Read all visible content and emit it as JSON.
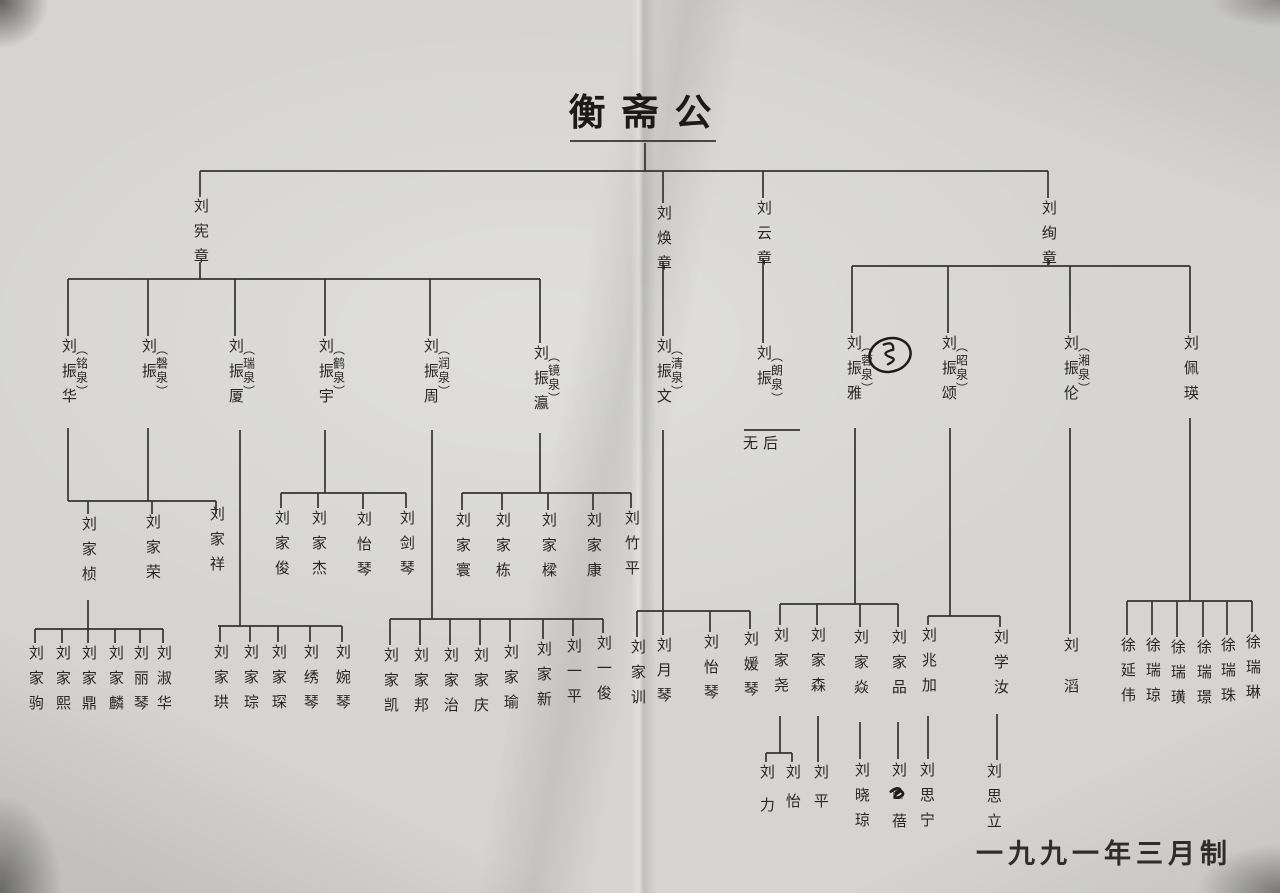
{
  "page": {
    "title": "衡斋公",
    "footer_date": "一九九一年三月制"
  },
  "colors": {
    "paper": "#d5d4d0",
    "ink": "#272624",
    "line": "#34332f"
  },
  "tree": {
    "root": "衡斋公",
    "no_descendants_note": "无后",
    "nodes": [
      {
        "id": "xianzhang",
        "name": "刘宪章",
        "x": 200,
        "y": 198
      },
      {
        "id": "huanzhang",
        "name": "刘焕章",
        "x": 663,
        "y": 205
      },
      {
        "id": "yunzhang",
        "name": "刘云章",
        "x": 763,
        "y": 200
      },
      {
        "id": "xuanzhang",
        "name": "刘绚章",
        "x": 1048,
        "y": 200
      },
      {
        "id": "zhenhua",
        "name": "刘振华",
        "paren": "铭泉",
        "x": 68,
        "y": 338
      },
      {
        "id": "zhen-qingquan",
        "name": "刘振",
        "paren": "磬泉",
        "x": 148,
        "y": 338
      },
      {
        "id": "zhensha",
        "name": "刘振厦",
        "paren": "瑞泉",
        "x": 235,
        "y": 338
      },
      {
        "id": "zhenyu",
        "name": "刘振宇",
        "paren": "鹤泉",
        "x": 325,
        "y": 338
      },
      {
        "id": "zhenzhou",
        "name": "刘振周",
        "paren": "润泉",
        "x": 430,
        "y": 338
      },
      {
        "id": "zhenying",
        "name": "刘振瀛",
        "paren": "镜泉",
        "x": 540,
        "y": 345
      },
      {
        "id": "zhenwen",
        "name": "刘振文",
        "paren": "清泉",
        "x": 663,
        "y": 338
      },
      {
        "id": "zhen-langquan",
        "name": "刘振",
        "paren": "朗泉",
        "x": 763,
        "y": 345
      },
      {
        "id": "wuhou",
        "name": "无后",
        "x": 763,
        "y": 437,
        "horizontal": true
      },
      {
        "id": "zhenya",
        "name": "刘振雅",
        "paren": "蓉泉",
        "x": 853,
        "y": 335
      },
      {
        "id": "zhensong",
        "name": "刘振颂",
        "paren": "昭泉",
        "x": 948,
        "y": 335
      },
      {
        "id": "zhenlun",
        "name": "刘振伦",
        "paren": "湘泉",
        "x": 1070,
        "y": 335
      },
      {
        "id": "peiying",
        "name": "刘佩瑛",
        "x": 1190,
        "y": 335
      },
      {
        "id": "jiazhen",
        "name": "刘家桢",
        "x": 88,
        "y": 516
      },
      {
        "id": "jiarong",
        "name": "刘家荣",
        "x": 152,
        "y": 514
      },
      {
        "id": "jiaxiang",
        "name": "刘家祥",
        "x": 216,
        "y": 506
      },
      {
        "id": "jiajun",
        "name": "刘家俊",
        "x": 281,
        "y": 510
      },
      {
        "id": "jiajie",
        "name": "刘家杰",
        "x": 318,
        "y": 510
      },
      {
        "id": "yiqin-a",
        "name": "刘怡琴",
        "x": 363,
        "y": 511
      },
      {
        "id": "jianqin",
        "name": "刘剑琴",
        "x": 406,
        "y": 510
      },
      {
        "id": "jiahuan",
        "name": "刘家寰",
        "x": 462,
        "y": 512
      },
      {
        "id": "jiadong",
        "name": "刘家栋",
        "x": 502,
        "y": 512
      },
      {
        "id": "jialiang",
        "name": "刘家樑",
        "x": 548,
        "y": 512
      },
      {
        "id": "jiakang",
        "name": "刘家康",
        "x": 593,
        "y": 512
      },
      {
        "id": "zhuping",
        "name": "刘竹平",
        "x": 631,
        "y": 510
      },
      {
        "id": "jiaju",
        "name": "刘家驹",
        "x": 35,
        "y": 645
      },
      {
        "id": "jiaxi",
        "name": "刘家熙",
        "x": 62,
        "y": 645
      },
      {
        "id": "jiading",
        "name": "刘家鼎",
        "x": 88,
        "y": 645
      },
      {
        "id": "jialin",
        "name": "刘家麟",
        "x": 115,
        "y": 645
      },
      {
        "id": "liqin",
        "name": "刘丽琴",
        "x": 140,
        "y": 645
      },
      {
        "id": "shuhua",
        "name": "刘淑华",
        "x": 163,
        "y": 645
      },
      {
        "id": "jiagong",
        "name": "刘家珙",
        "x": 220,
        "y": 644
      },
      {
        "id": "jiacong",
        "name": "刘家琮",
        "x": 250,
        "y": 644
      },
      {
        "id": "jiachen",
        "name": "刘家琛",
        "x": 278,
        "y": 644
      },
      {
        "id": "xiuqin",
        "name": "刘绣琴",
        "x": 310,
        "y": 644
      },
      {
        "id": "wanqin",
        "name": "刘婉琴",
        "x": 342,
        "y": 644
      },
      {
        "id": "jiakai",
        "name": "刘家凯",
        "x": 390,
        "y": 647
      },
      {
        "id": "jiabang",
        "name": "刘家邦",
        "x": 420,
        "y": 647
      },
      {
        "id": "jiazhi",
        "name": "刘家治",
        "x": 450,
        "y": 647
      },
      {
        "id": "jiaqing",
        "name": "刘家庆",
        "x": 480,
        "y": 647
      },
      {
        "id": "jiayu",
        "name": "刘家瑜",
        "x": 510,
        "y": 644
      },
      {
        "id": "jiaxin",
        "name": "刘家新",
        "x": 543,
        "y": 641
      },
      {
        "id": "yiping",
        "name": "刘一平",
        "x": 573,
        "y": 638
      },
      {
        "id": "yijun",
        "name": "刘一俊",
        "x": 603,
        "y": 635
      },
      {
        "id": "jiaxun",
        "name": "刘家训",
        "x": 637,
        "y": 639
      },
      {
        "id": "yueqin",
        "name": "刘月琴",
        "x": 663,
        "y": 637
      },
      {
        "id": "yiqin-b",
        "name": "刘怡琴",
        "x": 710,
        "y": 634
      },
      {
        "id": "yuanqin",
        "name": "刘媛琴",
        "x": 750,
        "y": 631
      },
      {
        "id": "jiayao",
        "name": "刘家尧",
        "x": 780,
        "y": 627
      },
      {
        "id": "jiasen",
        "name": "刘家森",
        "x": 817,
        "y": 627
      },
      {
        "id": "jiayan",
        "name": "刘家焱",
        "x": 860,
        "y": 629
      },
      {
        "id": "jiapin",
        "name": "刘家品",
        "x": 898,
        "y": 629
      },
      {
        "id": "zhaojia",
        "name": "刘兆加",
        "x": 928,
        "y": 627
      },
      {
        "id": "xueru",
        "name": "刘学汝",
        "x": 1000,
        "y": 629
      },
      {
        "id": "tao",
        "name": "刘滔",
        "x": 1070,
        "y": 637,
        "gap": 26
      },
      {
        "id": "xu-yanwei",
        "name": "徐延伟",
        "x": 1127,
        "y": 637
      },
      {
        "id": "xu-ruiqiong",
        "name": "徐瑞琼",
        "x": 1152,
        "y": 637
      },
      {
        "id": "xu-ruihuang",
        "name": "徐瑞璜",
        "x": 1177,
        "y": 639
      },
      {
        "id": "xu-ruijing",
        "name": "徐瑞璟",
        "x": 1203,
        "y": 639
      },
      {
        "id": "xu-ruizhu",
        "name": "徐瑞珠",
        "x": 1227,
        "y": 637
      },
      {
        "id": "xu-ruilin",
        "name": "徐瑞琳",
        "x": 1252,
        "y": 634
      },
      {
        "id": "li",
        "name": "刘力",
        "x": 766,
        "y": 764,
        "gap": 18
      },
      {
        "id": "yi",
        "name": "刘怡",
        "x": 792,
        "y": 764,
        "gap": 14
      },
      {
        "id": "ping",
        "name": "刘平",
        "x": 820,
        "y": 764,
        "gap": 14
      },
      {
        "id": "xiaoqiong",
        "name": "刘晓琼",
        "x": 861,
        "y": 762
      },
      {
        "id": "bei",
        "name": "刘□蓓",
        "x": 898,
        "y": 762
      },
      {
        "id": "sining",
        "name": "刘思宁",
        "x": 926,
        "y": 762
      },
      {
        "id": "sili",
        "name": "刘思立",
        "x": 993,
        "y": 763
      }
    ],
    "edges": [
      [
        645,
        143,
        645,
        171
      ],
      [
        570,
        141,
        716,
        141
      ],
      [
        200,
        171,
        1048,
        171
      ],
      [
        200,
        171,
        200,
        197
      ],
      [
        663,
        171,
        663,
        203
      ],
      [
        763,
        171,
        763,
        198
      ],
      [
        1048,
        171,
        1048,
        198
      ],
      [
        200,
        262,
        200,
        279
      ],
      [
        68,
        279,
        540,
        279
      ],
      [
        68,
        279,
        68,
        336
      ],
      [
        148,
        279,
        148,
        336
      ],
      [
        235,
        279,
        235,
        336
      ],
      [
        325,
        279,
        325,
        336
      ],
      [
        430,
        279,
        430,
        336
      ],
      [
        540,
        279,
        540,
        343
      ],
      [
        663,
        262,
        663,
        336
      ],
      [
        763,
        258,
        763,
        343
      ],
      [
        744,
        430,
        800,
        430
      ],
      [
        1048,
        258,
        1048,
        266
      ],
      [
        852,
        266,
        1190,
        266
      ],
      [
        852,
        266,
        852,
        333
      ],
      [
        948,
        266,
        948,
        333
      ],
      [
        1070,
        266,
        1070,
        333
      ],
      [
        1190,
        266,
        1190,
        333
      ],
      [
        68,
        428,
        68,
        501
      ],
      [
        148,
        428,
        148,
        501
      ],
      [
        68,
        501,
        216,
        501
      ],
      [
        88,
        501,
        88,
        514
      ],
      [
        152,
        501,
        152,
        514
      ],
      [
        216,
        501,
        216,
        514
      ],
      [
        325,
        430,
        325,
        493
      ],
      [
        281,
        493,
        406,
        493
      ],
      [
        281,
        493,
        281,
        508
      ],
      [
        318,
        493,
        318,
        508
      ],
      [
        363,
        493,
        363,
        509
      ],
      [
        406,
        493,
        406,
        508
      ],
      [
        540,
        433,
        540,
        493
      ],
      [
        462,
        493,
        631,
        493
      ],
      [
        462,
        493,
        462,
        510
      ],
      [
        502,
        493,
        502,
        510
      ],
      [
        548,
        493,
        548,
        510
      ],
      [
        593,
        493,
        593,
        510
      ],
      [
        631,
        493,
        631,
        508
      ],
      [
        240,
        430,
        240,
        626
      ],
      [
        218,
        626,
        342,
        626
      ],
      [
        220,
        626,
        220,
        642
      ],
      [
        250,
        626,
        250,
        642
      ],
      [
        278,
        626,
        278,
        642
      ],
      [
        310,
        626,
        310,
        642
      ],
      [
        342,
        626,
        342,
        642
      ],
      [
        88,
        600,
        88,
        629
      ],
      [
        35,
        629,
        163,
        629
      ],
      [
        35,
        629,
        35,
        643
      ],
      [
        62,
        629,
        62,
        643
      ],
      [
        88,
        629,
        88,
        643
      ],
      [
        115,
        629,
        115,
        643
      ],
      [
        140,
        629,
        140,
        643
      ],
      [
        163,
        629,
        163,
        643
      ],
      [
        432,
        430,
        432,
        619
      ],
      [
        390,
        619,
        603,
        619
      ],
      [
        390,
        619,
        390,
        645
      ],
      [
        420,
        619,
        420,
        645
      ],
      [
        450,
        619,
        450,
        645
      ],
      [
        480,
        619,
        480,
        645
      ],
      [
        510,
        619,
        510,
        642
      ],
      [
        543,
        619,
        543,
        639
      ],
      [
        573,
        619,
        573,
        636
      ],
      [
        603,
        619,
        603,
        633
      ],
      [
        663,
        430,
        663,
        611
      ],
      [
        637,
        611,
        750,
        611
      ],
      [
        637,
        611,
        637,
        637
      ],
      [
        663,
        611,
        663,
        635
      ],
      [
        710,
        611,
        710,
        632
      ],
      [
        750,
        611,
        750,
        629
      ],
      [
        855,
        428,
        855,
        604
      ],
      [
        780,
        604,
        898,
        604
      ],
      [
        780,
        604,
        780,
        625
      ],
      [
        817,
        604,
        817,
        625
      ],
      [
        860,
        604,
        860,
        627
      ],
      [
        898,
        604,
        898,
        627
      ],
      [
        950,
        428,
        950,
        616
      ],
      [
        928,
        616,
        1000,
        616
      ],
      [
        928,
        616,
        928,
        625
      ],
      [
        1000,
        616,
        1000,
        627
      ],
      [
        1070,
        428,
        1070,
        634
      ],
      [
        1190,
        418,
        1190,
        601
      ],
      [
        1127,
        601,
        1252,
        601
      ],
      [
        1127,
        601,
        1127,
        635
      ],
      [
        1152,
        601,
        1152,
        635
      ],
      [
        1177,
        601,
        1177,
        637
      ],
      [
        1203,
        601,
        1203,
        637
      ],
      [
        1227,
        601,
        1227,
        635
      ],
      [
        1252,
        601,
        1252,
        632
      ],
      [
        780,
        716,
        780,
        753
      ],
      [
        766,
        753,
        792,
        753
      ],
      [
        766,
        753,
        766,
        762
      ],
      [
        792,
        753,
        792,
        762
      ],
      [
        818,
        716,
        818,
        762
      ],
      [
        860,
        722,
        860,
        759
      ],
      [
        898,
        722,
        898,
        759
      ],
      [
        928,
        716,
        928,
        759
      ],
      [
        997,
        714,
        997,
        760
      ]
    ]
  },
  "annotations": [
    {
      "type": "circled-scribble",
      "x": 890,
      "y": 355,
      "size": 52
    },
    {
      "type": "ink-scribble",
      "x": 898,
      "y": 794,
      "size": 30
    }
  ]
}
